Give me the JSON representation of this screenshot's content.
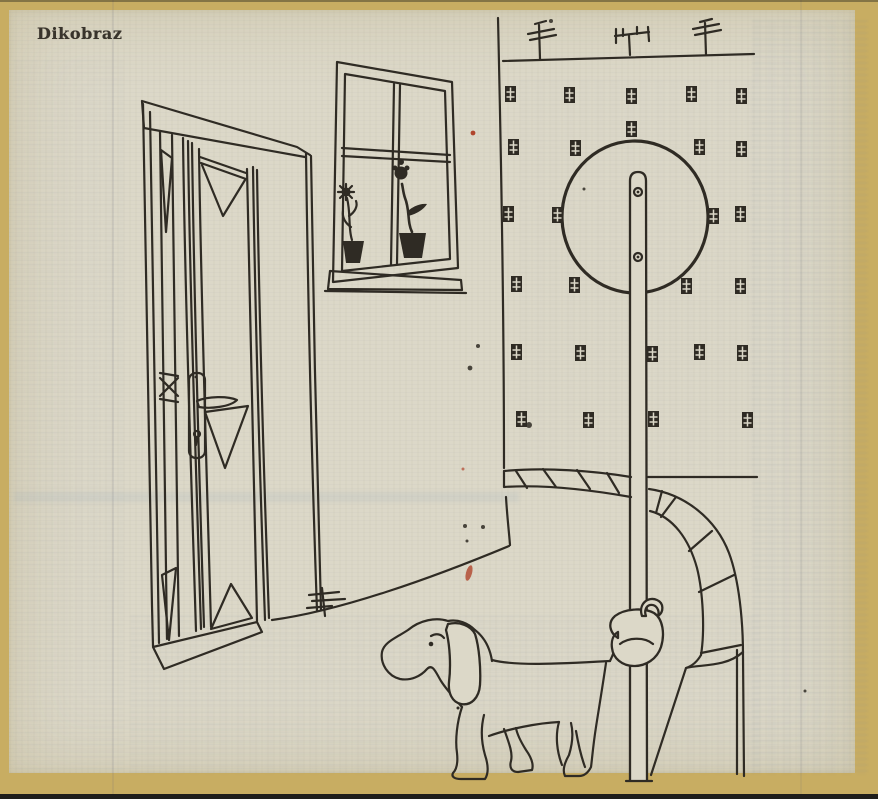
{
  "masthead": {
    "title": "Dikobraz"
  },
  "colors": {
    "border_gold": "#c8ad62",
    "paper": "#dcd8c8",
    "ink": "#2f2b24",
    "accent_red": "#b0452c",
    "edge_dark": "#1f1e1b"
  },
  "illustration": {
    "scene_elements": {
      "door": "panelled door with handle and keyhole",
      "window": "window with two potted flowers on the sill",
      "building": "apartment facade with rows of small windows and tv antennas",
      "sign": "round sign on a tall pole with two bolts",
      "arch": "stone arch at lower right",
      "dog": "dog with its tail knotted around the sign pole",
      "tuft": "small antenna-like tuft at the door corner"
    }
  }
}
